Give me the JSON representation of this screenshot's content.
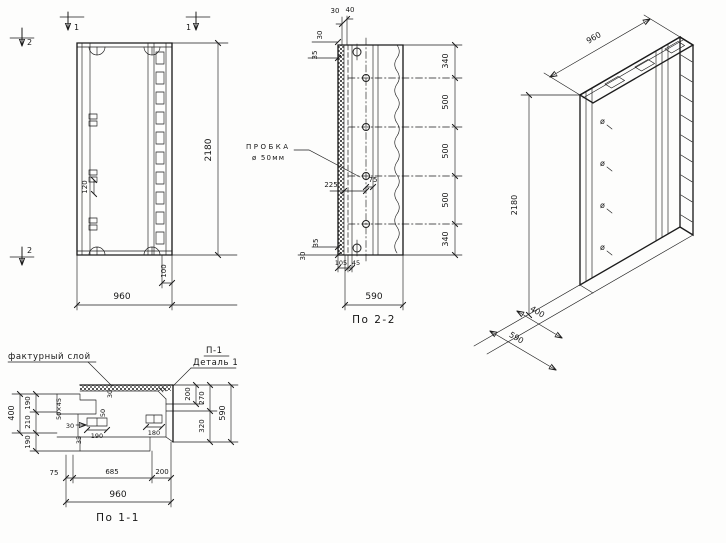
{
  "drawing": {
    "ink": "#1d1d1d",
    "paper": "#fdfdfc",
    "front": {
      "mark1": "1",
      "mark2": "2",
      "h": "2180",
      "w": "960",
      "d100": "100",
      "d120": "120"
    },
    "s22": {
      "caption": "По 2-2",
      "plug1": "ПРОБКА",
      "plug2": "ø 50мм",
      "t30": "30",
      "t40": "40",
      "l30": "30",
      "l35": "35",
      "d225": "225",
      "d75": "75",
      "seg": [
        "340",
        "500",
        "500",
        "500",
        "340"
      ],
      "b35": "35",
      "b30": "30",
      "b105": "105",
      "b45": "45",
      "w": "590"
    },
    "iso": {
      "w": "960",
      "h": "2180",
      "d1": "400",
      "d2": "590",
      "hole": "ø"
    },
    "s11": {
      "caption": "По 1-1",
      "layer": "фактурный слой",
      "p1": "П-1",
      "detail": "Деталь 1",
      "total": "400",
      "segs": [
        "190",
        "210",
        "190"
      ],
      "s5045": "50×45",
      "a30": "30",
      "a35": "35",
      "a190": "190",
      "a180": "180",
      "r30": "30",
      "r50": "50",
      "r200": "200",
      "r270": "270",
      "r320": "320",
      "r590": "590",
      "b75": "75",
      "b685": "685",
      "b200": "200",
      "b960": "960"
    }
  }
}
